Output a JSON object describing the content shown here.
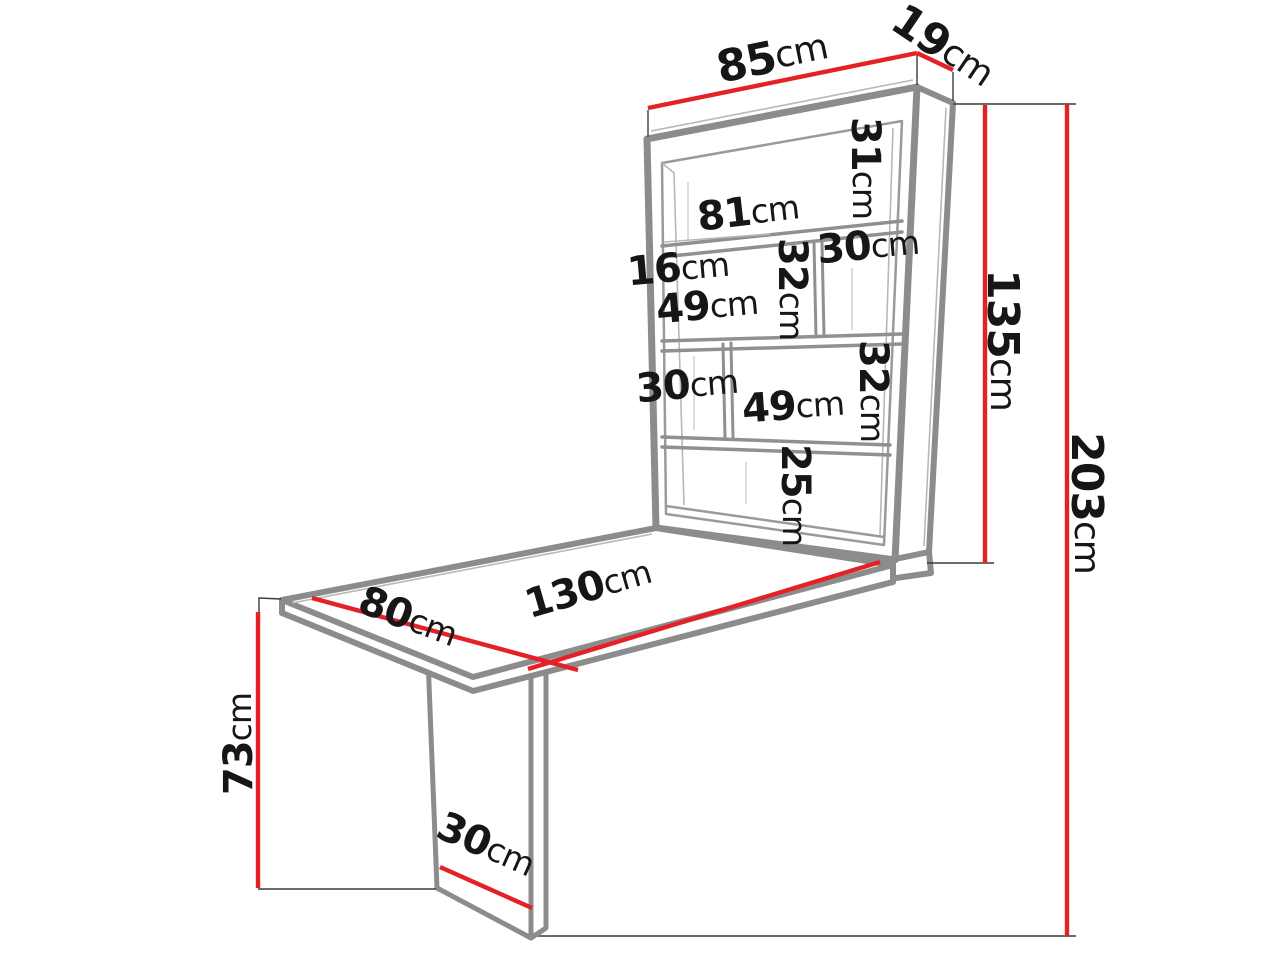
{
  "diagram_type": "furniture-dimension-drawing",
  "unit_label": "cm",
  "colors": {
    "dimension_line_red": "#e52128",
    "furniture_outline_gray": "#8c8c8c",
    "label_text": "#161616",
    "background": "#ffffff"
  },
  "dims": {
    "cabinet_width": {
      "value": "85",
      "unit": "cm"
    },
    "cabinet_depth": {
      "value": "19",
      "unit": "cm"
    },
    "row1_height": {
      "value": "31",
      "unit": "cm"
    },
    "inner_width": {
      "value": "81",
      "unit": "cm"
    },
    "row2_right_width": {
      "value": "30",
      "unit": "cm"
    },
    "shelf_depth": {
      "value": "16",
      "unit": "cm"
    },
    "row2_height": {
      "value": "32",
      "unit": "cm"
    },
    "row2_left_width": {
      "value": "49",
      "unit": "cm"
    },
    "row3_left_width": {
      "value": "30",
      "unit": "cm"
    },
    "row3_right_width": {
      "value": "49",
      "unit": "cm"
    },
    "row3_height": {
      "value": "32",
      "unit": "cm"
    },
    "row4_height": {
      "value": "25",
      "unit": "cm"
    },
    "cabinet_height": {
      "value": "135",
      "unit": "cm"
    },
    "total_height": {
      "value": "203",
      "unit": "cm"
    },
    "desk_width": {
      "value": "80",
      "unit": "cm"
    },
    "desk_length": {
      "value": "130",
      "unit": "cm"
    },
    "desk_height": {
      "value": "73",
      "unit": "cm"
    },
    "leg_width": {
      "value": "30",
      "unit": "cm"
    }
  }
}
